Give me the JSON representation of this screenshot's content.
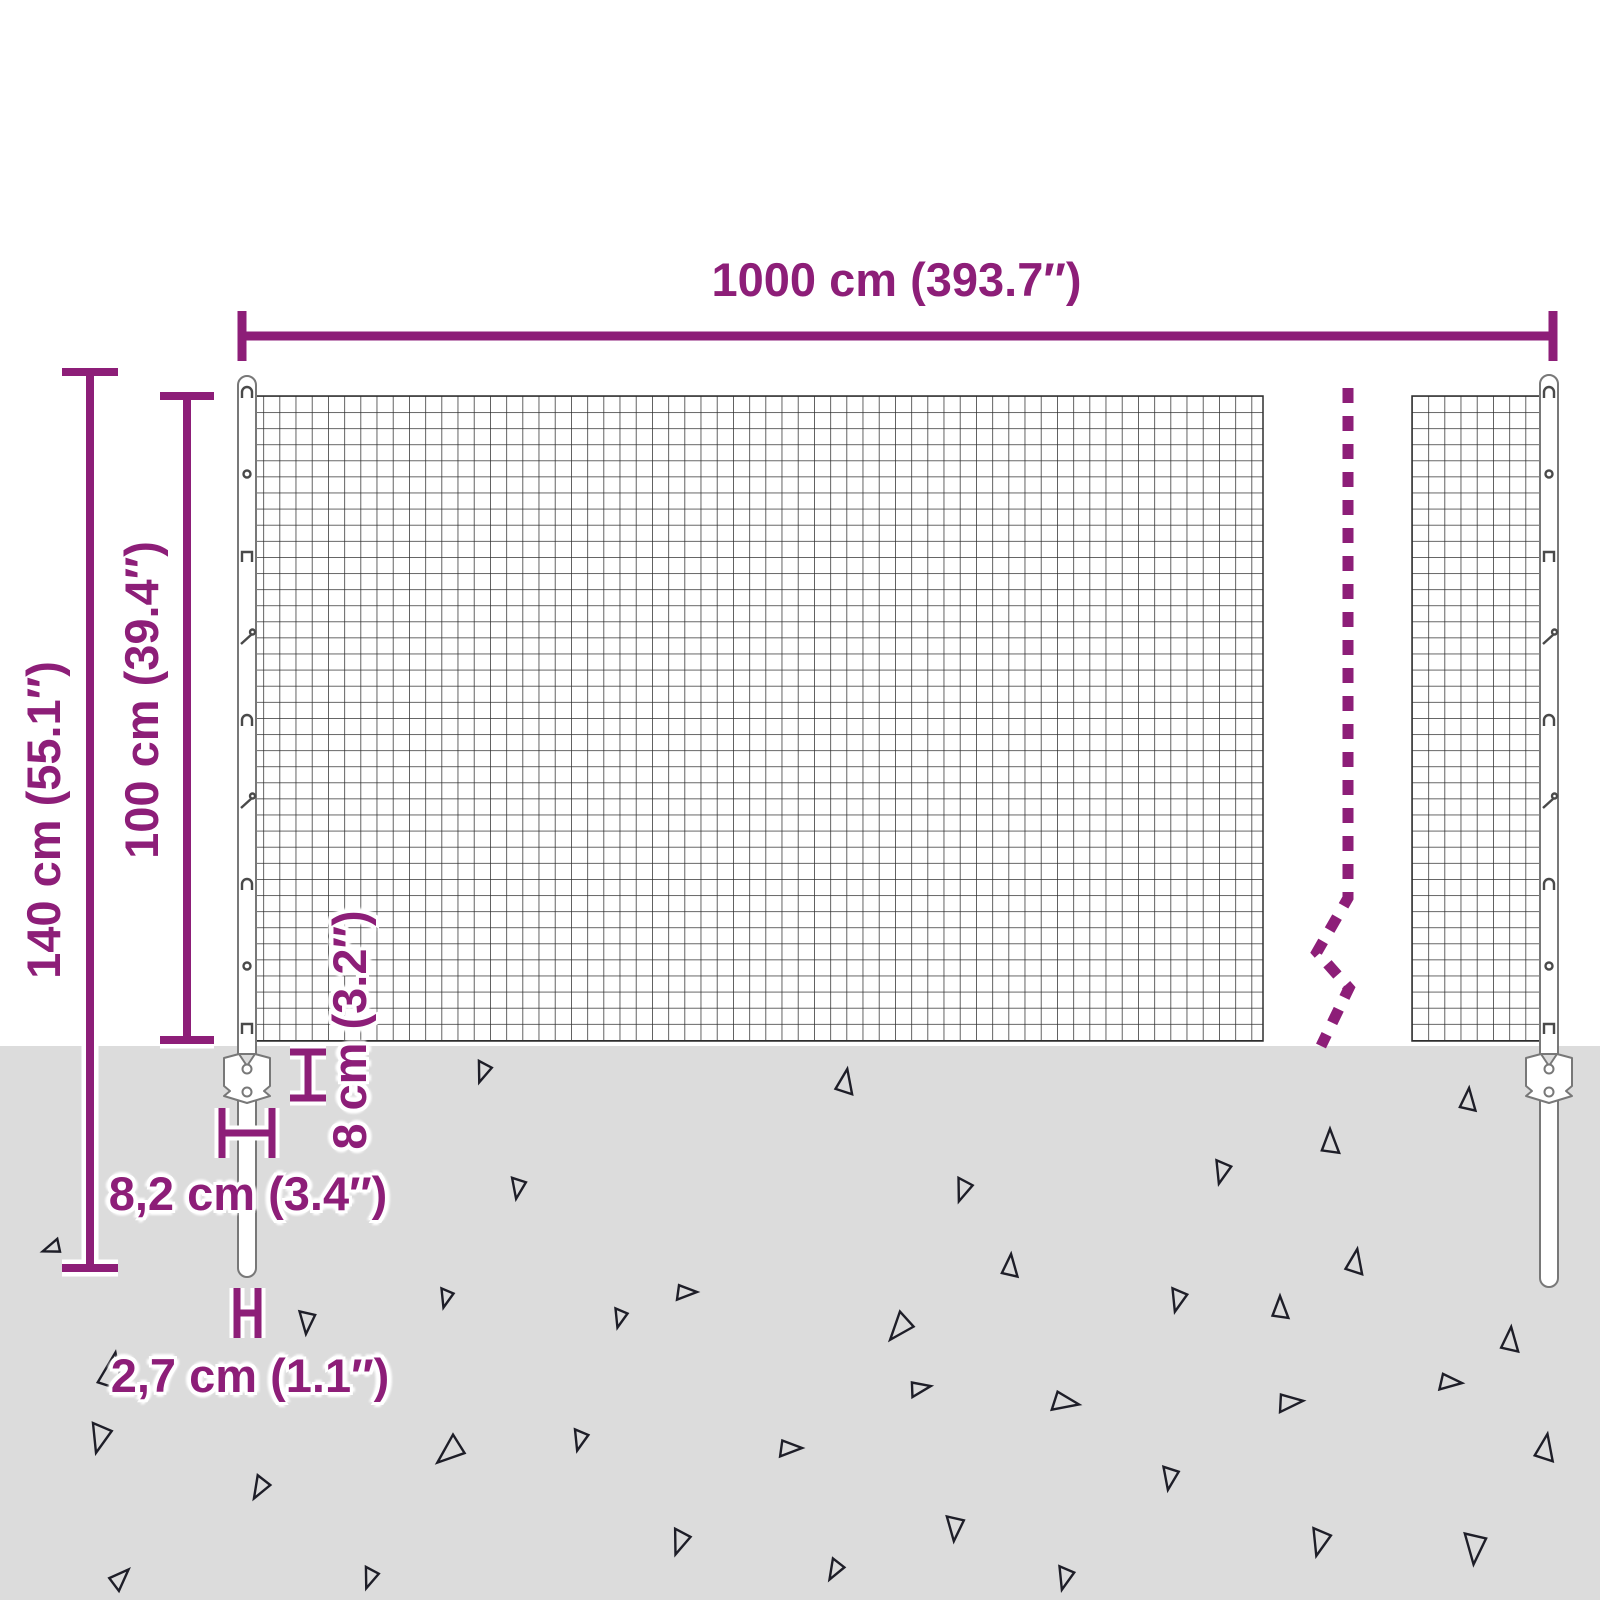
{
  "diagram": {
    "title": "wire-mesh-fence-dimension-diagram",
    "subject": "garden wire mesh fence panel with two posts, underground anchor plates and gravel ground"
  },
  "colors": {
    "accent": "#8d1e78",
    "background": "#ffffff",
    "ground": "#dcdcdc",
    "wire": "#2f2f2f",
    "post-outline": "#787878",
    "triangle": "#1e1e28",
    "clip": "#4a4a4a"
  },
  "dimensions": {
    "fence_width": "1000 cm (393.7″)",
    "total_height": "140 cm (55.1″)",
    "mesh_height": "100 cm (39.4″)",
    "anchor_height": "8 cm (3.2″)",
    "anchor_width": "8,2 cm (3.4″)",
    "post_diameter": "2,7 cm (1.1″)"
  },
  "posts": {
    "clip_glyphs": [
      "hook",
      "eye",
      "staple",
      "nail",
      "hook",
      "nail",
      "hook",
      "eye",
      "staple"
    ],
    "clip_y": [
      392,
      474,
      556,
      638,
      720,
      802,
      884,
      966,
      1028
    ],
    "centers_x": [
      247,
      1549
    ]
  },
  "ground": {
    "triangles": [
      {
        "x": 52,
        "y": 1248,
        "s": 18,
        "r": 250
      },
      {
        "x": 483,
        "y": 1072,
        "s": 20,
        "r": 200
      },
      {
        "x": 845,
        "y": 1082,
        "s": 24,
        "r": 10
      },
      {
        "x": 1468,
        "y": 1100,
        "s": 22,
        "r": 5
      },
      {
        "x": 1330,
        "y": 1142,
        "s": 24,
        "r": 0
      },
      {
        "x": 1222,
        "y": 1172,
        "s": 22,
        "r": 195
      },
      {
        "x": 963,
        "y": 1190,
        "s": 22,
        "r": 200
      },
      {
        "x": 518,
        "y": 1188,
        "s": 20,
        "r": 190
      },
      {
        "x": 307,
        "y": 1322,
        "s": 22,
        "r": 185
      },
      {
        "x": 686,
        "y": 1292,
        "s": 20,
        "r": 90
      },
      {
        "x": 1355,
        "y": 1262,
        "s": 24,
        "r": 10
      },
      {
        "x": 1178,
        "y": 1300,
        "s": 22,
        "r": 195
      },
      {
        "x": 446,
        "y": 1298,
        "s": 18,
        "r": 195
      },
      {
        "x": 112,
        "y": 1372,
        "s": 36,
        "r": 10
      },
      {
        "x": 1510,
        "y": 1340,
        "s": 24,
        "r": 5
      },
      {
        "x": 1280,
        "y": 1308,
        "s": 22,
        "r": 0
      },
      {
        "x": 900,
        "y": 1328,
        "s": 28,
        "r": 220
      },
      {
        "x": 1010,
        "y": 1266,
        "s": 22,
        "r": 5
      },
      {
        "x": 620,
        "y": 1318,
        "s": 18,
        "r": 195
      },
      {
        "x": 100,
        "y": 1438,
        "s": 28,
        "r": 195
      },
      {
        "x": 260,
        "y": 1488,
        "s": 22,
        "r": 210
      },
      {
        "x": 450,
        "y": 1452,
        "s": 30,
        "r": 230
      },
      {
        "x": 580,
        "y": 1440,
        "s": 20,
        "r": 195
      },
      {
        "x": 680,
        "y": 1542,
        "s": 24,
        "r": 200
      },
      {
        "x": 790,
        "y": 1448,
        "s": 22,
        "r": 90
      },
      {
        "x": 920,
        "y": 1388,
        "s": 20,
        "r": 80
      },
      {
        "x": 955,
        "y": 1528,
        "s": 24,
        "r": 185
      },
      {
        "x": 1065,
        "y": 1402,
        "s": 26,
        "r": 100
      },
      {
        "x": 1170,
        "y": 1478,
        "s": 22,
        "r": 190
      },
      {
        "x": 1290,
        "y": 1402,
        "s": 24,
        "r": 85
      },
      {
        "x": 1320,
        "y": 1542,
        "s": 26,
        "r": 195
      },
      {
        "x": 1450,
        "y": 1382,
        "s": 22,
        "r": 95
      },
      {
        "x": 1475,
        "y": 1548,
        "s": 30,
        "r": 185
      },
      {
        "x": 1545,
        "y": 1448,
        "s": 26,
        "r": 10
      },
      {
        "x": 120,
        "y": 1578,
        "s": 22,
        "r": 45
      },
      {
        "x": 370,
        "y": 1578,
        "s": 20,
        "r": 200
      },
      {
        "x": 835,
        "y": 1570,
        "s": 20,
        "r": 210
      },
      {
        "x": 1065,
        "y": 1578,
        "s": 22,
        "r": 195
      }
    ]
  }
}
